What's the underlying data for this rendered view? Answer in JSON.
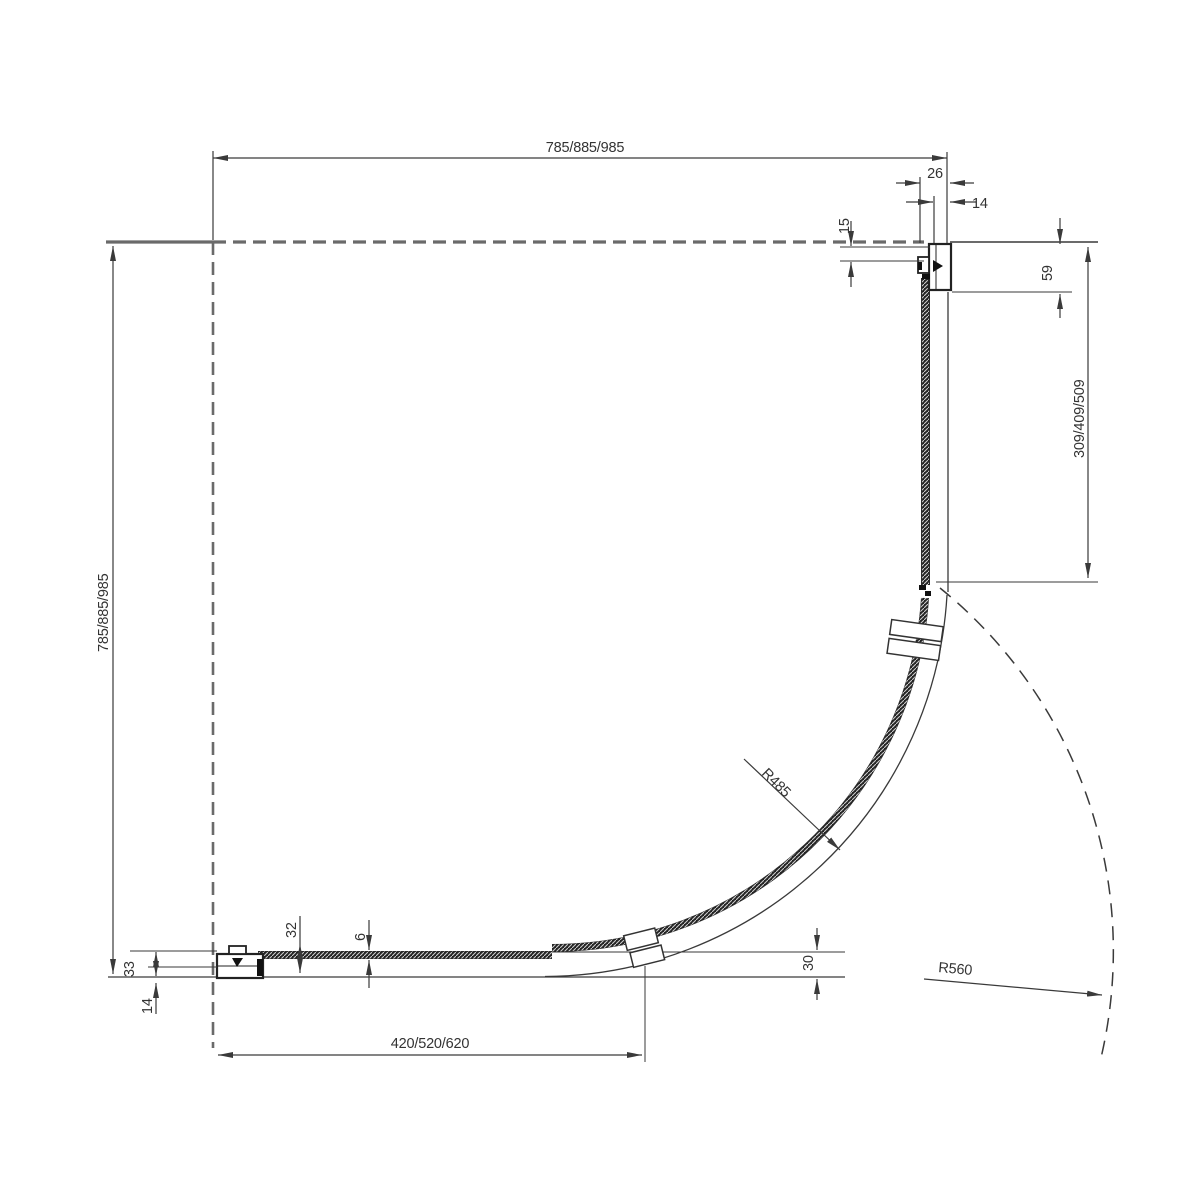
{
  "drawing": {
    "title": "quadrant shower enclosure plan view",
    "colors": {
      "line": "#3a3a3a",
      "wall": "#6a6a6a",
      "glass": "#242424",
      "background": "#ffffff"
    },
    "labels": {
      "width_top": "785/885/985",
      "height_left": "785/885/985",
      "profile_width_top": "26",
      "profile_inset_top": "14",
      "wall_offset_top": "15",
      "corner_inset_right": "59",
      "side_panel_length": "309/409/509",
      "bottom_panel_length": "420/520/620",
      "profile_height_bottom": "33",
      "profile_inset_bottom": "14",
      "glass_offset_bottom": "32",
      "glass_thickness": "6",
      "rim_width": "30",
      "radius_glass": "R485",
      "radius_swing": "R560"
    }
  }
}
